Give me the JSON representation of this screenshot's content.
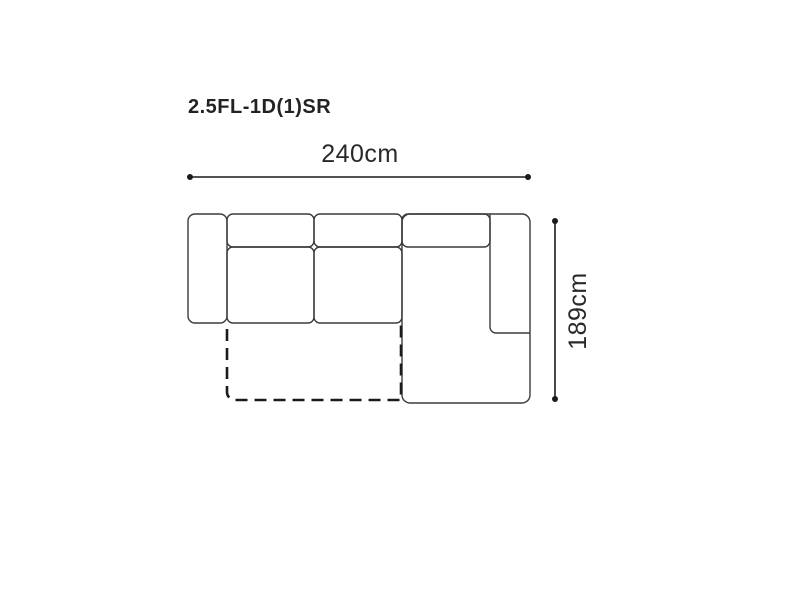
{
  "diagram": {
    "model_code": "2.5FL-1D(1)SR",
    "width_label": "240cm",
    "depth_label": "189cm"
  },
  "icons": {
    "dimension_endpoint": "filled-dot"
  },
  "colors": {
    "background": "#ffffff",
    "sofa_outline": "#3d3a3b",
    "dimension_line": "#1c1a1b",
    "dashed_bed_outline": "#1c1a1b",
    "text": "#242122"
  }
}
